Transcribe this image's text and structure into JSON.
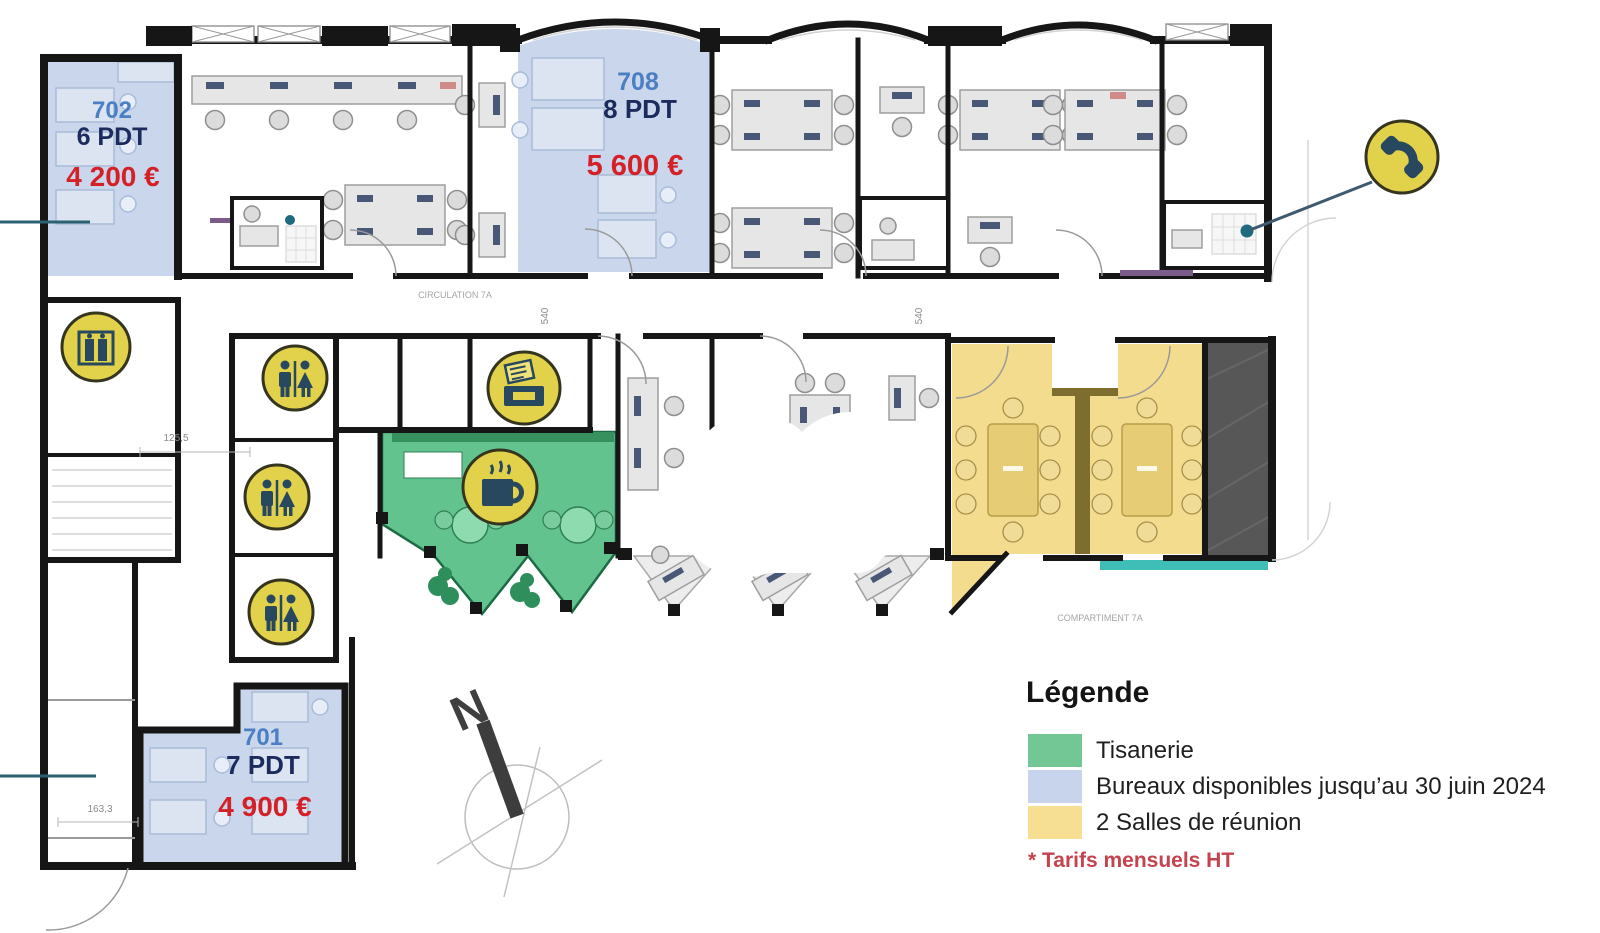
{
  "rooms": {
    "r702": {
      "number": "702",
      "capacity": "6 PDT",
      "price": "4 200 €"
    },
    "r708": {
      "number": "708",
      "capacity": "8 PDT",
      "price": "5 600 €"
    },
    "r701": {
      "number": "701",
      "capacity": "7 PDT",
      "price": "4 900 €"
    }
  },
  "legend": {
    "title": "Légende",
    "items": [
      {
        "label": "Tisanerie",
        "color": "#72c795"
      },
      {
        "label": "Bureaux disponibles jusqu’au 30 juin 2024",
        "color": "#c7d4ec"
      },
      {
        "label": "2 Salles de réunion",
        "color": "#f6df93"
      }
    ],
    "footnote": "* Tarifs mensuels HT"
  },
  "compass": {
    "north_label": "N"
  },
  "annotations": {
    "circulation": "CIRCULATION 7A",
    "compartiment": "COMPARTIMENT 7A",
    "dim_hall": "125,5",
    "dim_lower": "163,3",
    "dim_corridor_a": "540",
    "dim_corridor_b": "540"
  },
  "icons": [
    "elevator-icon",
    "restroom-icon",
    "restroom-icon",
    "restroom-icon",
    "printer-icon",
    "coffee-icon",
    "phone-icon"
  ],
  "colors": {
    "available_office": "#c7d4ec",
    "tisanerie": "#63c38e",
    "meeting_room": "#f4dc8e",
    "icon_badge": "#e2d24b",
    "icon_glyph": "#27485e",
    "price_red": "#d42127",
    "room_number_blue": "#4a7fc4",
    "capacity_navy": "#1c2b5e",
    "terrace_gray": "#575757",
    "teal_accent": "#3fbdb7",
    "wall_black": "#161616"
  }
}
